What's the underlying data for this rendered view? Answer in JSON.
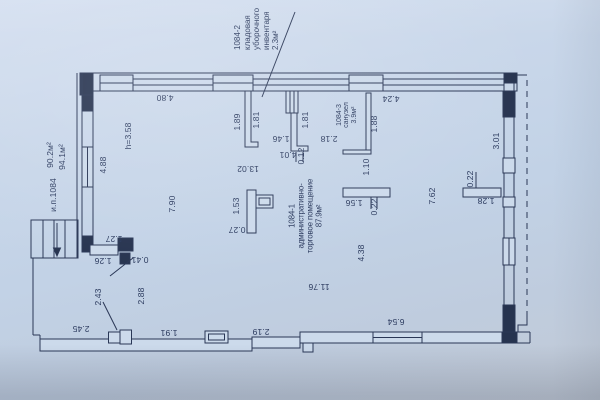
{
  "plan": {
    "paper_color": "#c4d4e6",
    "ink_color": "#2a3756",
    "unit_label": {
      "lines": [
        "1084-2",
        "кладовая",
        "уборочного",
        "инвентаря",
        "2.3м²"
      ]
    },
    "main_room_label": {
      "lines": [
        "1084-1",
        "административно-",
        "торговое помещение",
        "87.9м²"
      ]
    },
    "bathroom_label": {
      "lines": [
        "1084-3",
        "санузел",
        "3.9м²"
      ]
    },
    "dimensions": [
      {
        "t": "4.80",
        "x": 165,
        "y": 97.5,
        "r": "u"
      },
      {
        "t": "4.24",
        "x": 391,
        "y": 99,
        "r": "u"
      },
      {
        "t": "1.89",
        "x": 236.5,
        "y": 122,
        "r": "v"
      },
      {
        "t": "1.81",
        "x": 256,
        "y": 120,
        "r": "v"
      },
      {
        "t": "1.81",
        "x": 304.5,
        "y": 120,
        "r": "v"
      },
      {
        "t": "1.88",
        "x": 374,
        "y": 124,
        "r": "v"
      },
      {
        "t": "1.46",
        "x": 281,
        "y": 139,
        "r": "u"
      },
      {
        "t": "4.01",
        "x": 288,
        "y": 154.5,
        "r": "u"
      },
      {
        "t": "0.12",
        "x": 300.5,
        "y": 156,
        "r": "v"
      },
      {
        "t": "2.18",
        "x": 329,
        "y": 138.5,
        "r": "u"
      },
      {
        "t": "13.02",
        "x": 248,
        "y": 168.5,
        "r": "u"
      },
      {
        "t": "1.10",
        "x": 366,
        "y": 167,
        "r": "v"
      },
      {
        "t": "1.56",
        "x": 353.5,
        "y": 202.5,
        "r": "u"
      },
      {
        "t": "0.22",
        "x": 373.5,
        "y": 206.5,
        "r": "v"
      },
      {
        "t": "0.22",
        "x": 470,
        "y": 178.5,
        "r": "v"
      },
      {
        "t": "1.28",
        "x": 486,
        "y": 201,
        "r": "u"
      },
      {
        "t": "3.01",
        "x": 496,
        "y": 141,
        "r": "v"
      },
      {
        "t": "7.62",
        "x": 431.5,
        "y": 196,
        "r": "v"
      },
      {
        "t": "4.88",
        "x": 102.5,
        "y": 165,
        "r": "v"
      },
      {
        "t": "h=3.58",
        "x": 128,
        "y": 136,
        "r": "v"
      },
      {
        "t": "7.90",
        "x": 172,
        "y": 203.5,
        "r": "v"
      },
      {
        "t": "1.53",
        "x": 236,
        "y": 206,
        "r": "v"
      },
      {
        "t": "0.27",
        "x": 236.5,
        "y": 229.5,
        "r": "u"
      },
      {
        "t": "1.27",
        "x": 114,
        "y": 238.5,
        "r": "u"
      },
      {
        "t": "1.26",
        "x": 103,
        "y": 261,
        "r": "u"
      },
      {
        "t": "0.41",
        "x": 139.5,
        "y": 260,
        "r": "u"
      },
      {
        "t": "2.43",
        "x": 98,
        "y": 297,
        "r": "v"
      },
      {
        "t": "2.88",
        "x": 140.5,
        "y": 296,
        "r": "v"
      },
      {
        "t": "2.45",
        "x": 81,
        "y": 329,
        "r": "u"
      },
      {
        "t": "1.91",
        "x": 169,
        "y": 332.5,
        "r": "u"
      },
      {
        "t": "2.19",
        "x": 261,
        "y": 331.5,
        "r": "u"
      },
      {
        "t": "6.54",
        "x": 396,
        "y": 321.5,
        "r": "u"
      },
      {
        "t": "11.76",
        "x": 319,
        "y": 287,
        "r": "u"
      },
      {
        "t": "4.38",
        "x": 361,
        "y": 253,
        "r": "v"
      },
      {
        "t": "90.2м²",
        "x": 50,
        "y": 155,
        "r": "v"
      },
      {
        "t": "94.1м²",
        "x": 61.5,
        "y": 156.5,
        "r": "v"
      },
      {
        "t": "и.п.1084",
        "x": 52.5,
        "y": 195,
        "r": "v"
      }
    ]
  }
}
